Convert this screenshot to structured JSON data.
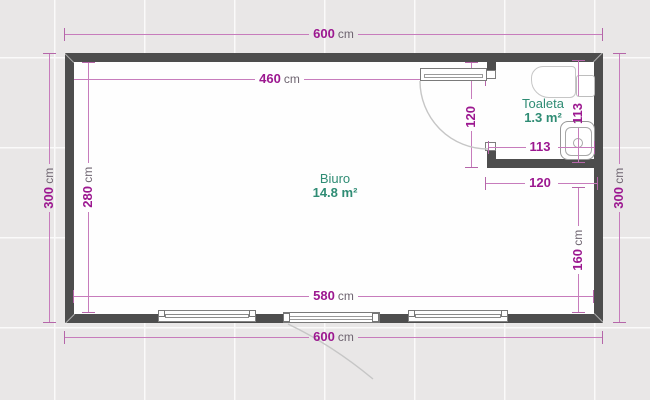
{
  "plan": {
    "rooms": [
      {
        "name": "Biuro",
        "area": "14.8 m²"
      },
      {
        "name": "Toaleta",
        "area": "1.3 m²"
      }
    ],
    "dims": {
      "top600": {
        "v": "600",
        "u": "cm"
      },
      "inner460": {
        "v": "460",
        "u": "cm"
      },
      "left300": {
        "v": "300",
        "u": "cm"
      },
      "inner280": {
        "v": "280",
        "u": "cm"
      },
      "right300": {
        "v": "300",
        "u": "cm"
      },
      "door120v": {
        "v": "120",
        "u": ""
      },
      "wc113v": {
        "v": "113",
        "u": ""
      },
      "wc113h": {
        "v": "113",
        "u": ""
      },
      "wc120h": {
        "v": "120",
        "u": ""
      },
      "right160": {
        "v": "160",
        "u": "cm"
      },
      "bottom580": {
        "v": "580",
        "u": "cm"
      },
      "bottom600": {
        "v": "600",
        "u": "cm"
      }
    },
    "colors": {
      "wall": "#4d4d4d",
      "dim_number": "#9c1890",
      "dim_line": "#c77cbc",
      "unit_text": "#6e6470",
      "room_label": "#2f8c74"
    }
  }
}
